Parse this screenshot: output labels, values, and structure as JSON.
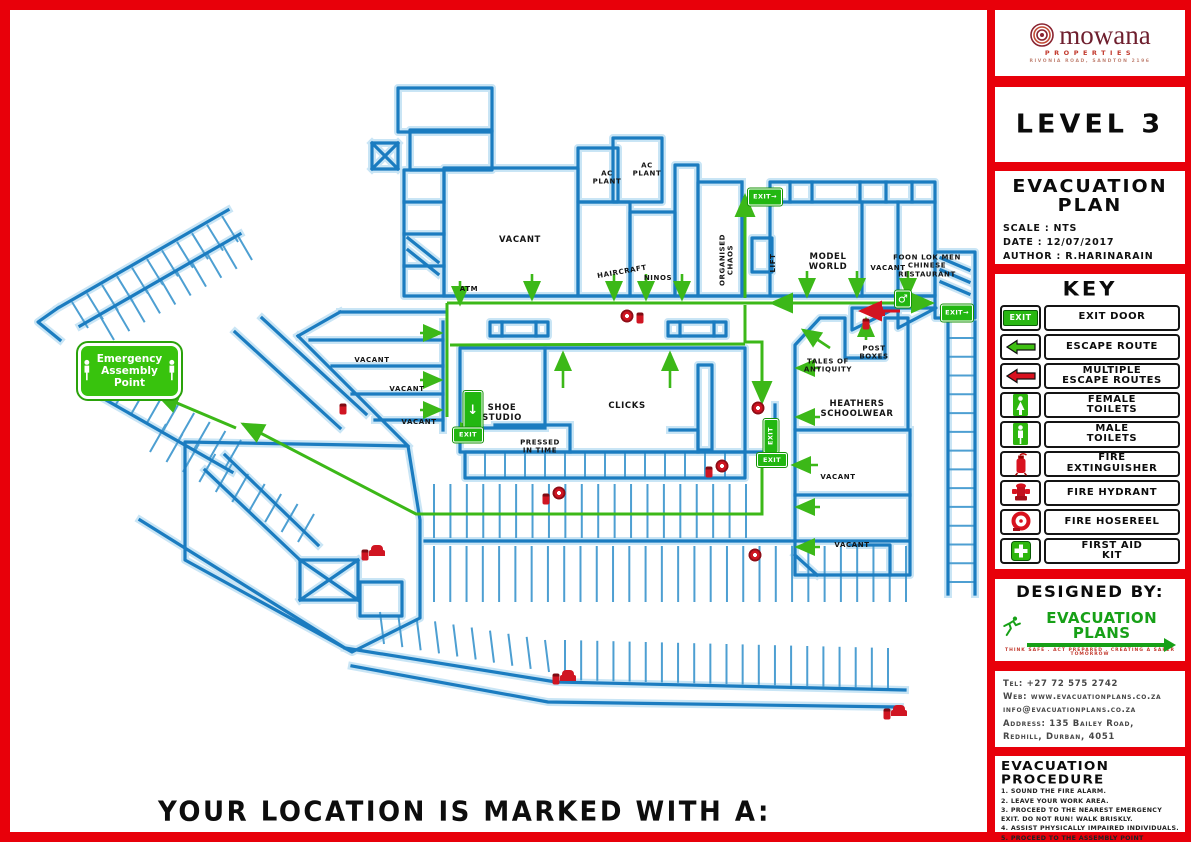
{
  "colors": {
    "frame_red": "#e8000a",
    "wall_blue": "#1b7cc0",
    "route_green": "#3cb818",
    "sign_green": "#22b711",
    "equipment_red": "#d01522"
  },
  "branding": {
    "logo_name": "mowana",
    "logo_subtitle": "PROPERTIES",
    "logo_address": "RIVONIA ROAD, SANDTON 2196"
  },
  "plan": {
    "level": "LEVEL 3",
    "title": "EVACUATION PLAN",
    "scale": "SCALE : NTS",
    "date": "DATE : 12/07/2017",
    "author": "AUTHOR : R.HARINARAIN"
  },
  "key": {
    "title": "KEY",
    "items": [
      {
        "icon": "exit-door",
        "label": "EXIT DOOR"
      },
      {
        "icon": "escape-route",
        "label": "ESCAPE ROUTE"
      },
      {
        "icon": "multiple-escape-routes",
        "label": "MULTIPLE\nESCAPE ROUTES"
      },
      {
        "icon": "female-toilets",
        "label": "FEMALE\nTOILETS"
      },
      {
        "icon": "male-toilets",
        "label": "MALE\nTOILETS"
      },
      {
        "icon": "fire-extinguisher",
        "label": "FIRE\nEXTINGUISHER"
      },
      {
        "icon": "fire-hydrant",
        "label": "FIRE HYDRANT"
      },
      {
        "icon": "fire-hosereel",
        "label": "FIRE HOSEREEL"
      },
      {
        "icon": "first-aid-kit",
        "label": "FIRST AID\nKIT"
      }
    ]
  },
  "designed_by": {
    "heading": "DESIGNED BY:",
    "logo_text": "EVACUATION PLANS",
    "tagline": "THINK SAFE . ACT PREPARED . CREATING A SAFER TOMORROW"
  },
  "contact": {
    "lines": [
      "Tel: +27 72 575 2742",
      "Web: www.evacuationplans.co.za",
      "info@evacuationplans.co.za",
      "Address: 135 Bailey Road,",
      "Redhill, Durban, 4051"
    ]
  },
  "procedure": {
    "title": "EVACUATION PROCEDURE",
    "steps": [
      "1. SOUND THE FIRE ALARM.",
      "2. LEAVE YOUR WORK AREA.",
      "3. PROCEED TO THE NEAREST EMERGENCY EXIT. DO NOT RUN! WALK BRISKLY.",
      "4. ASSIST PHYSICALLY IMPAIRED INDIVIDUALS.",
      "5. PROCEED TO THE ASSEMBLY POINT LOCATED OUTSIDE."
    ]
  },
  "page": {
    "bottom_note": "YOUR LOCATION IS MARKED WITH A:"
  },
  "map": {
    "assembly_point": {
      "text": "Emergency\nAssembly\nPoint"
    },
    "labels": [
      {
        "t": "VACANT",
        "x": 510,
        "y": 230
      },
      {
        "t": "AC\nPLANT",
        "x": 597,
        "y": 168,
        "s": 1
      },
      {
        "t": "AC\nPLANT",
        "x": 637,
        "y": 160,
        "s": 1
      },
      {
        "t": "HAIRCRAFT",
        "x": 612,
        "y": 262,
        "r": -10,
        "s": 1
      },
      {
        "t": "NINOS",
        "x": 648,
        "y": 268,
        "s": 1
      },
      {
        "t": "ORGANISED\nCHAOS",
        "x": 717,
        "y": 250,
        "r": -90,
        "s": 1
      },
      {
        "t": "MODEL\nWORLD",
        "x": 818,
        "y": 252
      },
      {
        "t": "VACANT",
        "x": 878,
        "y": 258,
        "s": 1
      },
      {
        "t": "FOON LOK MEN\nCHINESE\nRESTAURANT",
        "x": 917,
        "y": 256,
        "s": 1
      },
      {
        "t": "LIFT",
        "x": 763,
        "y": 253,
        "r": -90,
        "s": 1
      },
      {
        "t": "ATM",
        "x": 459,
        "y": 279,
        "s": 1
      },
      {
        "t": "VACANT",
        "x": 362,
        "y": 350,
        "s": 1
      },
      {
        "t": "VACANT",
        "x": 397,
        "y": 379,
        "s": 1
      },
      {
        "t": "VACANT",
        "x": 409,
        "y": 412,
        "s": 1
      },
      {
        "t": "SHOE\nSTUDIO",
        "x": 492,
        "y": 403
      },
      {
        "t": "CLICKS",
        "x": 617,
        "y": 396
      },
      {
        "t": "PRESSED\nIN TIME",
        "x": 530,
        "y": 437,
        "s": 1
      },
      {
        "t": "TALES OF\nANTIQUITY",
        "x": 818,
        "y": 356,
        "s": 1
      },
      {
        "t": "POST\nBOXES",
        "x": 864,
        "y": 343,
        "s": 1
      },
      {
        "t": "HEATHERS\nSCHOOLWEAR",
        "x": 847,
        "y": 399
      },
      {
        "t": "VACANT",
        "x": 828,
        "y": 467,
        "s": 1
      },
      {
        "t": "VACANT",
        "x": 842,
        "y": 535,
        "s": 1
      }
    ],
    "signs": [
      {
        "k": "exit-h",
        "x": 755,
        "y": 187,
        "w": 32,
        "h": 15
      },
      {
        "k": "exit-h",
        "x": 947,
        "y": 303,
        "w": 30,
        "h": 15
      },
      {
        "k": "exit-man",
        "x": 463,
        "y": 400,
        "w": 17,
        "h": 36
      },
      {
        "k": "exit-t",
        "x": 458,
        "y": 425,
        "w": 28,
        "h": 13
      },
      {
        "k": "exit-t",
        "x": 761,
        "y": 426,
        "w": 32,
        "h": 13,
        "r": -90
      },
      {
        "k": "exit-t",
        "x": 762,
        "y": 450,
        "w": 28,
        "h": 12
      },
      {
        "k": "wc",
        "x": 893,
        "y": 289,
        "w": 14,
        "h": 15
      }
    ],
    "equipment": [
      {
        "x": 617,
        "y": 306,
        "t": "hosereel"
      },
      {
        "x": 630,
        "y": 308,
        "t": "ext"
      },
      {
        "x": 867,
        "y": 300,
        "t": "hydrant"
      },
      {
        "x": 856,
        "y": 314,
        "t": "ext"
      },
      {
        "x": 748,
        "y": 398,
        "t": "hosereel"
      },
      {
        "x": 712,
        "y": 456,
        "t": "hosereel"
      },
      {
        "x": 699,
        "y": 462,
        "t": "ext"
      },
      {
        "x": 549,
        "y": 483,
        "t": "hosereel"
      },
      {
        "x": 536,
        "y": 489,
        "t": "ext"
      },
      {
        "x": 367,
        "y": 540,
        "t": "hydrant"
      },
      {
        "x": 355,
        "y": 545,
        "t": "ext"
      },
      {
        "x": 745,
        "y": 545,
        "t": "hosereel"
      },
      {
        "x": 558,
        "y": 665,
        "t": "hydrant"
      },
      {
        "x": 546,
        "y": 669,
        "t": "ext"
      },
      {
        "x": 889,
        "y": 700,
        "t": "hydrant"
      },
      {
        "x": 877,
        "y": 704,
        "t": "ext"
      },
      {
        "x": 333,
        "y": 399,
        "t": "ext"
      }
    ],
    "routes": [
      {
        "pts": [
          [
            745,
            298
          ],
          [
            745,
            196
          ]
        ],
        "he": true
      },
      {
        "pts": [
          [
            447,
            303
          ],
          [
            772,
            303
          ]
        ]
      },
      {
        "pts": [
          [
            772,
            303
          ],
          [
            932,
            303
          ]
        ],
        "hs": true,
        "he": true
      },
      {
        "pts": [
          [
            900,
            311
          ],
          [
            861,
            311
          ]
        ],
        "c": "r",
        "he": true
      },
      {
        "pts": [
          [
            745,
            305
          ],
          [
            745,
            342
          ],
          [
            762,
            342
          ],
          [
            762,
            402
          ]
        ],
        "he": true
      },
      {
        "pts": [
          [
            450,
            345
          ],
          [
            745,
            344
          ]
        ]
      },
      {
        "pts": [
          [
            447,
            303
          ],
          [
            447,
            417
          ]
        ]
      },
      {
        "pts": [
          [
            762,
            452
          ],
          [
            762,
            514
          ],
          [
            416,
            514
          ],
          [
            243,
            424
          ]
        ],
        "he": true
      },
      {
        "pts": [
          [
            236,
            428
          ],
          [
            158,
            395
          ]
        ],
        "he": true
      }
    ],
    "arrows": [
      [
        460,
        281,
        460,
        304
      ],
      [
        532,
        274,
        532,
        299
      ],
      [
        614,
        274,
        614,
        299
      ],
      [
        646,
        274,
        646,
        299
      ],
      [
        682,
        274,
        682,
        299
      ],
      [
        807,
        271,
        807,
        296
      ],
      [
        857,
        271,
        857,
        296
      ],
      [
        908,
        271,
        908,
        296
      ],
      [
        563,
        388,
        563,
        353
      ],
      [
        670,
        388,
        670,
        353
      ],
      [
        866,
        340,
        866,
        319
      ],
      [
        830,
        348,
        803,
        330
      ],
      [
        820,
        368,
        797,
        368
      ],
      [
        820,
        417,
        797,
        417
      ],
      [
        818,
        465,
        793,
        465
      ],
      [
        820,
        507,
        797,
        507
      ],
      [
        820,
        547,
        797,
        547
      ],
      [
        420,
        333,
        441,
        333
      ],
      [
        420,
        380,
        441,
        380
      ],
      [
        420,
        410,
        441,
        410
      ],
      [
        453,
        431,
        478,
        431
      ]
    ]
  }
}
